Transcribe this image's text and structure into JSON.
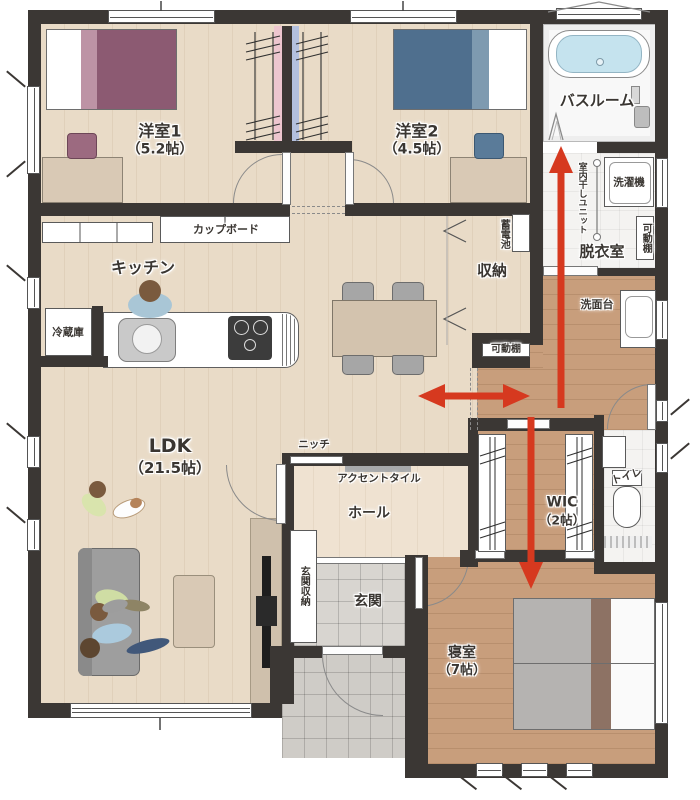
{
  "labels": {
    "room1_name": "洋室1",
    "room1_size": "（5.2帖）",
    "room2_name": "洋室2",
    "room2_size": "（4.5帖）",
    "bathroom": "バスルーム",
    "laundry_room": "脱衣室",
    "washing_machine": "洗濯機",
    "movable_shelf_right": "可動棚",
    "movable_shelf_center": "可動棚",
    "indoor_drying_unit": "室内干しユニット",
    "storage_battery": "蓄電池",
    "storage": "収納",
    "washstand": "洗面台",
    "kitchen": "キッチン",
    "cupboard": "カップボード",
    "refrigerator": "冷蔵庫",
    "ldk_name": "LDK",
    "ldk_size": "（21.5帖）",
    "niche": "ニッチ",
    "accent_tile": "アクセントタイル",
    "hall": "ホール",
    "entrance_storage": "玄関収納",
    "entrance": "玄関",
    "wic_name": "WIC",
    "wic_size": "（2帖）",
    "toilet": "トイレ",
    "bedroom_name": "寝室",
    "bedroom_size": "（7帖）"
  },
  "colors": {
    "wall": "#3b3734",
    "floor_light_wood": "#e9dbc7",
    "floor_dark_wood": "#c89e7c",
    "floor_hall": "#efe2d1",
    "tile_gray": "#d8d5d0",
    "bath_blue": "#c5e3ee",
    "arrow_red": "#d6391f",
    "bed1_purple": "#8c5a72",
    "bed2_blue": "#4f6f8e",
    "accent_tile_gray": "#a7a9ab",
    "furniture_beige": "#d9c9b5",
    "sofa_gray": "#9e9e9e"
  },
  "flow_arrows": {
    "color": "#d6391f",
    "directions": [
      "up-to-bathroom",
      "down-to-bedroom",
      "left-right-ldk-corridor"
    ]
  }
}
